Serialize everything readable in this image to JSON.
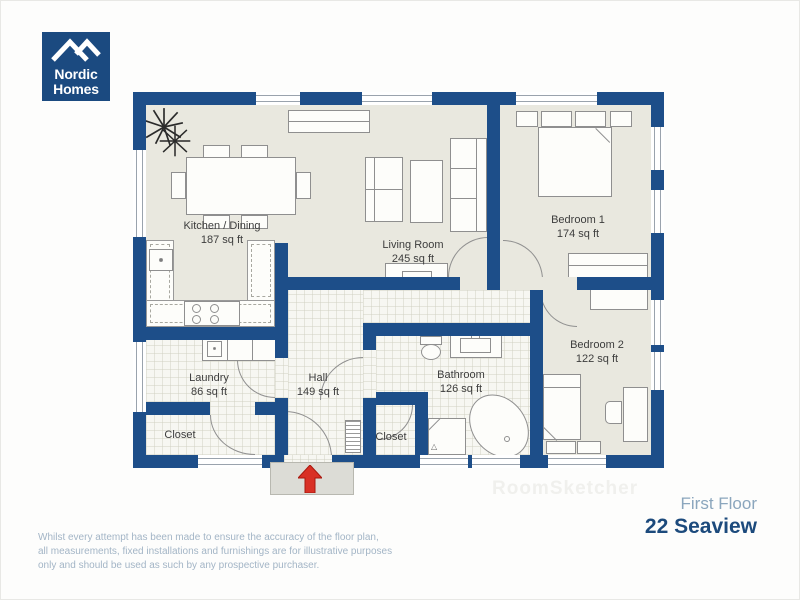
{
  "logo": {
    "line1": "Nordic",
    "line2": "Homes"
  },
  "rooms": {
    "kitchen": {
      "name": "Kitchen / Dining",
      "area": "187 sq ft"
    },
    "living": {
      "name": "Living Room",
      "area": "245 sq ft"
    },
    "bedroom1": {
      "name": "Bedroom 1",
      "area": "174 sq ft"
    },
    "bedroom2": {
      "name": "Bedroom 2",
      "area": "122 sq ft"
    },
    "laundry": {
      "name": "Laundry",
      "area": "86 sq ft"
    },
    "hall": {
      "name": "Hall",
      "area": "149 sq ft"
    },
    "bathroom": {
      "name": "Bathroom",
      "area": "126 sq ft"
    },
    "closet_left": {
      "name": "Closet"
    },
    "closet_right": {
      "name": "Closet"
    }
  },
  "footer": {
    "disclaimer_line1": "Whilst every attempt has been made to ensure the accuracy of the floor plan,",
    "disclaimer_line2": "all measurements, fixed installations and furnishings are for illustrative purposes",
    "disclaimer_line3": "only and should be used as such by any prospective purchaser.",
    "floor_label": "First Floor",
    "address": "22 Seaview"
  },
  "watermark": "RoomSketcher",
  "colors": {
    "wall": "#1d4e89",
    "floor": "#e9e8df",
    "logo": "#1b4a80",
    "accent_red": "#d93025",
    "text_light": "#a3b5c6",
    "address": "#1c4a7c"
  }
}
